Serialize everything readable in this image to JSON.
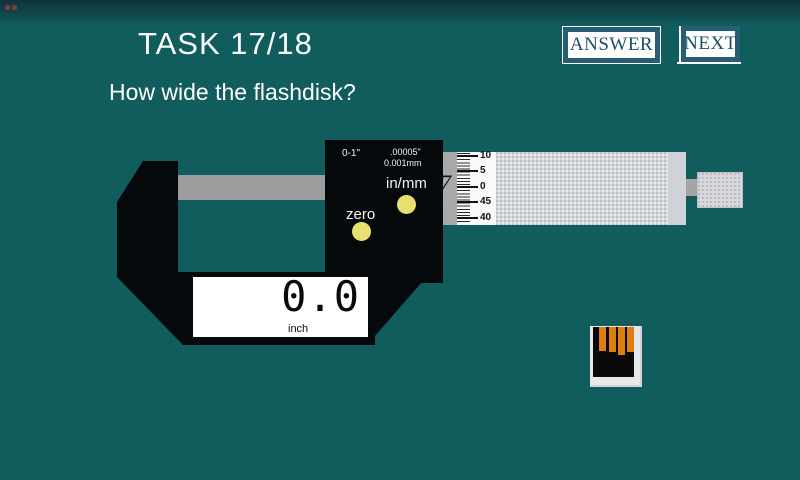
{
  "header": {
    "title": "TASK 17/18",
    "question": "How wide the flashdisk?"
  },
  "buttons": {
    "answer": "ANSWER",
    "next": "NEXT"
  },
  "micrometer": {
    "panel": {
      "range": "0-1\"",
      "res_inch": ".00005\"",
      "res_mm": "0.001mm",
      "inmm_label": "in/mm",
      "zero_label": "zero"
    },
    "display": {
      "value": "0.0",
      "unit": "inch"
    },
    "sleeve": {
      "digit": "7",
      "sub_digit": "0"
    },
    "thimble_scale": {
      "labels": [
        "10",
        "5",
        "0",
        "45",
        "40"
      ]
    }
  },
  "colors": {
    "background": "#115c5c",
    "button_frame": "#265e76",
    "button_text": "#1b4f66",
    "body_black": "#05090c",
    "yellow_button": "#e7df6e",
    "usb_pin_orange": "#dd7f10",
    "spindle_gray": "#9d9d9d",
    "barrel_gray": "#d7d8dc"
  }
}
